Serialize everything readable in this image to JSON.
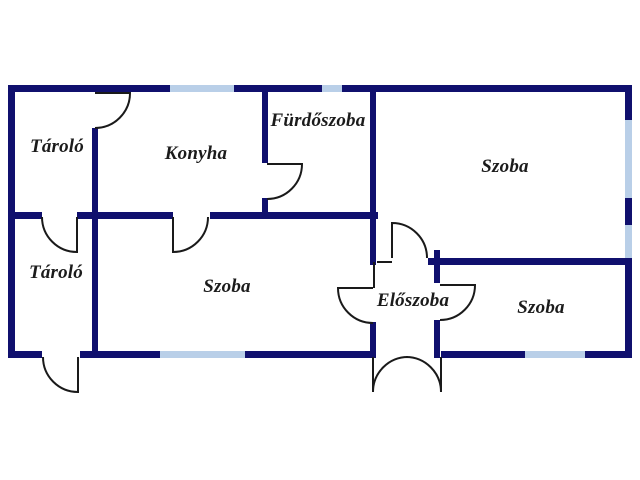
{
  "plan": {
    "title": "floor-plan",
    "colors": {
      "wall": "#10106e",
      "window": "#b9cfe8",
      "door_arc": "#1a1a1a",
      "label_text": "#1b1b1b",
      "background": "#ffffff"
    },
    "rooms": [
      {
        "id": "tarolo-upper-left",
        "label": "Tároló"
      },
      {
        "id": "konyha",
        "label": "Konyha"
      },
      {
        "id": "furdoszoba",
        "label": "Fürdőszoba"
      },
      {
        "id": "szoba-top-right",
        "label": "Szoba"
      },
      {
        "id": "tarolo-lower-left",
        "label": "Tároló"
      },
      {
        "id": "szoba-middle",
        "label": "Szoba"
      },
      {
        "id": "eloszoba",
        "label": "Előszoba"
      },
      {
        "id": "szoba-bottom-right",
        "label": "Szoba"
      }
    ],
    "windows": [
      {
        "wall": "top",
        "room": "konyha"
      },
      {
        "wall": "top",
        "room": "furdoszoba"
      },
      {
        "wall": "right",
        "room": "szoba-top-right-upper"
      },
      {
        "wall": "right",
        "room": "szoba-top-right-lower"
      },
      {
        "wall": "bottom",
        "room": "szoba-middle"
      },
      {
        "wall": "bottom",
        "room": "szoba-bottom-right"
      }
    ],
    "doors": [
      {
        "connects": "tarolo-upper-left / konyha"
      },
      {
        "connects": "konyha / furdoszoba"
      },
      {
        "connects": "tarolo-upper-left / tarolo-lower-left"
      },
      {
        "connects": "konyha / szoba-middle"
      },
      {
        "connects": "tarolo-lower-left / outside"
      },
      {
        "connects": "eloszoba / szoba-top-right"
      },
      {
        "connects": "szoba-middle / eloszoba"
      },
      {
        "connects": "eloszoba / szoba-bottom-right"
      },
      {
        "connects": "eloszoba / outside (double entrance)"
      }
    ]
  }
}
